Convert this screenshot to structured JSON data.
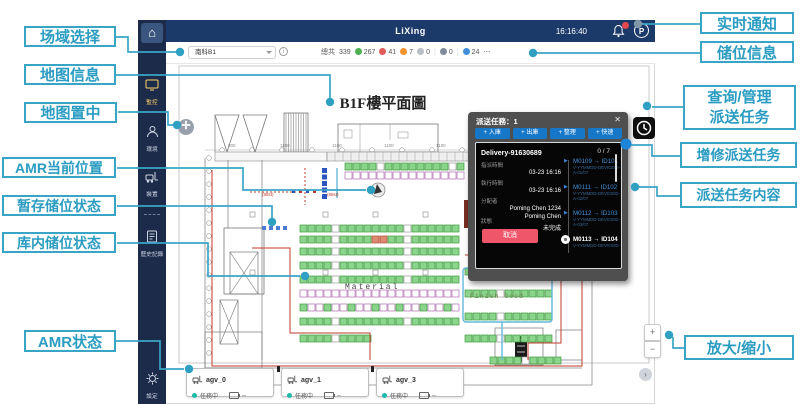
{
  "colors": {
    "accent_callout": "#39a5c6",
    "header_bg": "#1c3a69",
    "sidebar_bg": "#1d2b4a",
    "stat_green": "#4caf50",
    "stat_red": "#e05a5a",
    "stat_orange": "#f0922d",
    "stat_gray": "#b9bec6",
    "stat_slate": "#7f8a97",
    "stat_blue": "#3f8fd8",
    "task_button_blue": "#1677c9",
    "cancel_red": "#ef5669",
    "rack_green": "#8bd48b",
    "rack_purple": "#b070b0",
    "route_red": "#c23b2e",
    "route_blue": "#62b8dc"
  },
  "callouts": {
    "left": [
      {
        "label": "场域选择"
      },
      {
        "label": "地图信息"
      },
      {
        "label": "地图置中"
      },
      {
        "label": "AMR当前位置"
      },
      {
        "label": "暂存储位状态"
      },
      {
        "label": "库内储位状态"
      },
      {
        "label": "AMR状态"
      }
    ],
    "right": [
      {
        "label": "实时通知"
      },
      {
        "label": "储位信息"
      },
      {
        "label": "查询/管理",
        "label2": "派送任务"
      },
      {
        "label": "增修派送任务"
      },
      {
        "label": "派送任务内容"
      },
      {
        "label": "放大/缩小"
      }
    ]
  },
  "header": {
    "title": "LiXing",
    "time": "16:16:40",
    "avatar": "P"
  },
  "toolbar": {
    "field_selector": "南科B1",
    "info": "i",
    "total_label": "總共",
    "total": "339",
    "stats": [
      {
        "value": "267"
      },
      {
        "value": "41"
      },
      {
        "value": "7"
      },
      {
        "value": "0"
      },
      {
        "value": "0"
      },
      {
        "value": "24"
      }
    ],
    "more": "⋯"
  },
  "sidebar": {
    "items": [
      {
        "label": "監控"
      },
      {
        "label": "環境"
      },
      {
        "label": "裝置"
      },
      {
        "label": "歷史記錄"
      },
      {
        "label": "設定"
      }
    ]
  },
  "map": {
    "title": "B1F樓平面圖",
    "material_label": "Material",
    "finish_good_label": "Finish Good",
    "annotation1": "(88st)",
    "annotation2": "(88st)",
    "dims": [
      "800",
      "1100",
      "1100",
      "1100",
      "1100"
    ],
    "rack_rows": [
      {
        "y": 163,
        "x": 345,
        "n": 15,
        "v": "green"
      },
      {
        "y": 172,
        "x": 345,
        "n": 15,
        "v": "purple"
      },
      {
        "y": 225,
        "x": 300,
        "n": 20,
        "v": "green"
      },
      {
        "y": 236,
        "x": 300,
        "n": 20,
        "v": "green_red"
      },
      {
        "y": 248,
        "x": 300,
        "n": 20,
        "v": "green"
      },
      {
        "y": 262,
        "x": 300,
        "n": 20,
        "v": "green"
      },
      {
        "y": 276,
        "x": 300,
        "n": 20,
        "v": "green"
      },
      {
        "y": 290,
        "x": 300,
        "n": 20,
        "v": "purple"
      },
      {
        "y": 304,
        "x": 300,
        "n": 20,
        "v": "purple_mix"
      },
      {
        "y": 318,
        "x": 300,
        "n": 20,
        "v": "green"
      },
      {
        "y": 335,
        "x": 300,
        "n": 9,
        "v": "green"
      },
      {
        "y": 268,
        "x": 465,
        "n": 11,
        "v": "green"
      },
      {
        "y": 290,
        "x": 465,
        "n": 11,
        "v": "green"
      },
      {
        "y": 313,
        "x": 465,
        "n": 11,
        "v": "green"
      },
      {
        "y": 335,
        "x": 465,
        "n": 11,
        "v": "green"
      },
      {
        "y": 357,
        "x": 490,
        "n": 9,
        "v": "green"
      }
    ]
  },
  "task_panel": {
    "title": "派送任務：1",
    "close": "✕",
    "buttons": [
      {
        "label": "+ 入庫"
      },
      {
        "label": "+ 出庫"
      },
      {
        "label": "+ 整理"
      },
      {
        "label": "+ 快速"
      }
    ],
    "progress": "0 / 7",
    "delivery_id": "Delivery-91630689",
    "fields": [
      {
        "label": "指派時間",
        "value": "03-23 16:16"
      },
      {
        "label": "執行時間",
        "value": "03-23 16:16"
      },
      {
        "label": "分配者",
        "value": "Poming Chen 1234",
        "value2": "Poming Chen"
      },
      {
        "label": "狀態",
        "value": "未完成"
      }
    ],
    "cancel_label": "取消",
    "steps": [
      {
        "text": "M0109 → ID101",
        "sub": "V-YYMMDD-DEVICEID-",
        "sub2": "A-01/07"
      },
      {
        "text": "M0111 → ID102",
        "sub": "V-YYMMDD-DEVICEID-",
        "sub2": "A-02/07"
      },
      {
        "text": "M0112 → ID103",
        "sub": "V-YYMMDD-DEVICEID-",
        "sub2": "A-03/07"
      },
      {
        "text": "M0113 → ID104",
        "sub": "V-YYMMDD-DEVICEID-",
        "sub2": ""
      }
    ]
  },
  "agv_cards": [
    {
      "name": "agv_0",
      "status": "任務中",
      "battery": "--"
    },
    {
      "name": "agv_1",
      "status": "任務中",
      "battery": "--"
    },
    {
      "name": "agv_3",
      "status": "任務中",
      "battery": "--"
    }
  ],
  "controls": {
    "zoom_in": "+",
    "zoom_out": "−",
    "pan_next": "›",
    "center": "✛"
  }
}
